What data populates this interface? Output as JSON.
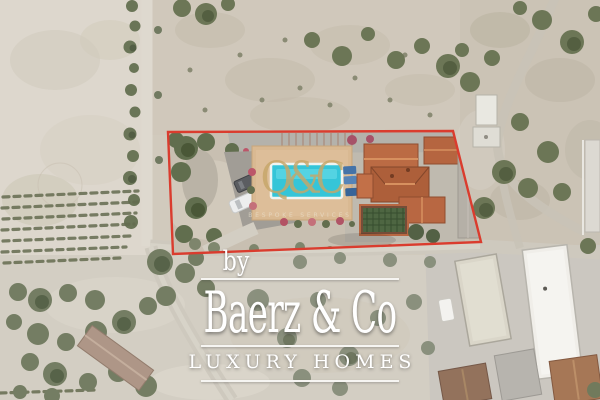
{
  "watermark": {
    "monogram": "Q&C",
    "tagline": "BESPOKE  SERVICES",
    "color": "#c6a668"
  },
  "brand": {
    "prefix": "by",
    "name": "Baerz & Co",
    "subtitle": "LUXURY HOMES",
    "text_color": "#ffffff"
  },
  "property_boundary": {
    "color": "#d93425",
    "points": "168,132 453,131 481,242 173,254"
  },
  "scene": {
    "description": "Aerial drone photo of a villa plot with swimming pool outlined in red, surrounded by dry fields, an orchard track, vineyard rows, roads and neighbouring white warehouse buildings",
    "terrain_color": "#d1cabd",
    "pool_color": "#2cc3d7",
    "villa_roof_color": "#b5613a",
    "vegetation_color": "#5d6847",
    "road_color": "#ccc7bc"
  }
}
